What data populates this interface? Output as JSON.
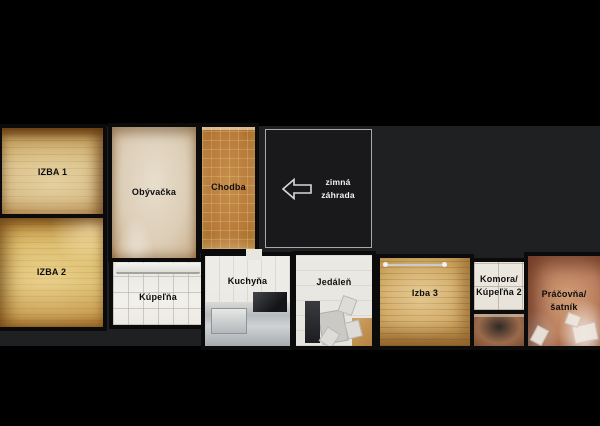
{
  "view": {
    "description": "top-down floor plan",
    "colors": {
      "letterbox": "#000000",
      "plan_background": "#1f2022",
      "wall": "#0b0b0c",
      "label_text": "#0d0d0d",
      "winter_garden_fill": "#19181b",
      "winter_garden_border": "#a8a8a8",
      "winter_garden_text": "#f2f2f2"
    }
  },
  "rooms": {
    "izba1": {
      "label": "IZBA 1",
      "floor_color": "#d5ba82"
    },
    "obyvacka": {
      "label": "Obývačka",
      "floor_color": "#dccdb6"
    },
    "chodba": {
      "label": "Chodba",
      "floor_color": "#b67a39"
    },
    "izba2": {
      "label": "IZBA 2",
      "floor_color": "#d9b866"
    },
    "kupelna": {
      "label": "Kúpeľňa",
      "floor_color": "#f0eee8"
    },
    "kuchyna": {
      "label": "Kuchyňa",
      "floor_color": "#ecebe6"
    },
    "jedalen": {
      "label": "Jedáleň",
      "floor_color": "#eae8e3"
    },
    "izba3": {
      "label": "Izba 3",
      "floor_color": "#cfa763"
    },
    "komora": {
      "line1": "Komora/",
      "line2": "Kúpeľňa 2",
      "floor_color": "#ebe7df"
    },
    "pracovna": {
      "line1": "Práčovňa/",
      "line2": "šatník",
      "floor_color": "#bd8261"
    },
    "zimna_zahrada": {
      "line1": "zimná",
      "line2": "záhrada"
    }
  },
  "icons": {
    "navigate_arrow": "arrow-left"
  }
}
